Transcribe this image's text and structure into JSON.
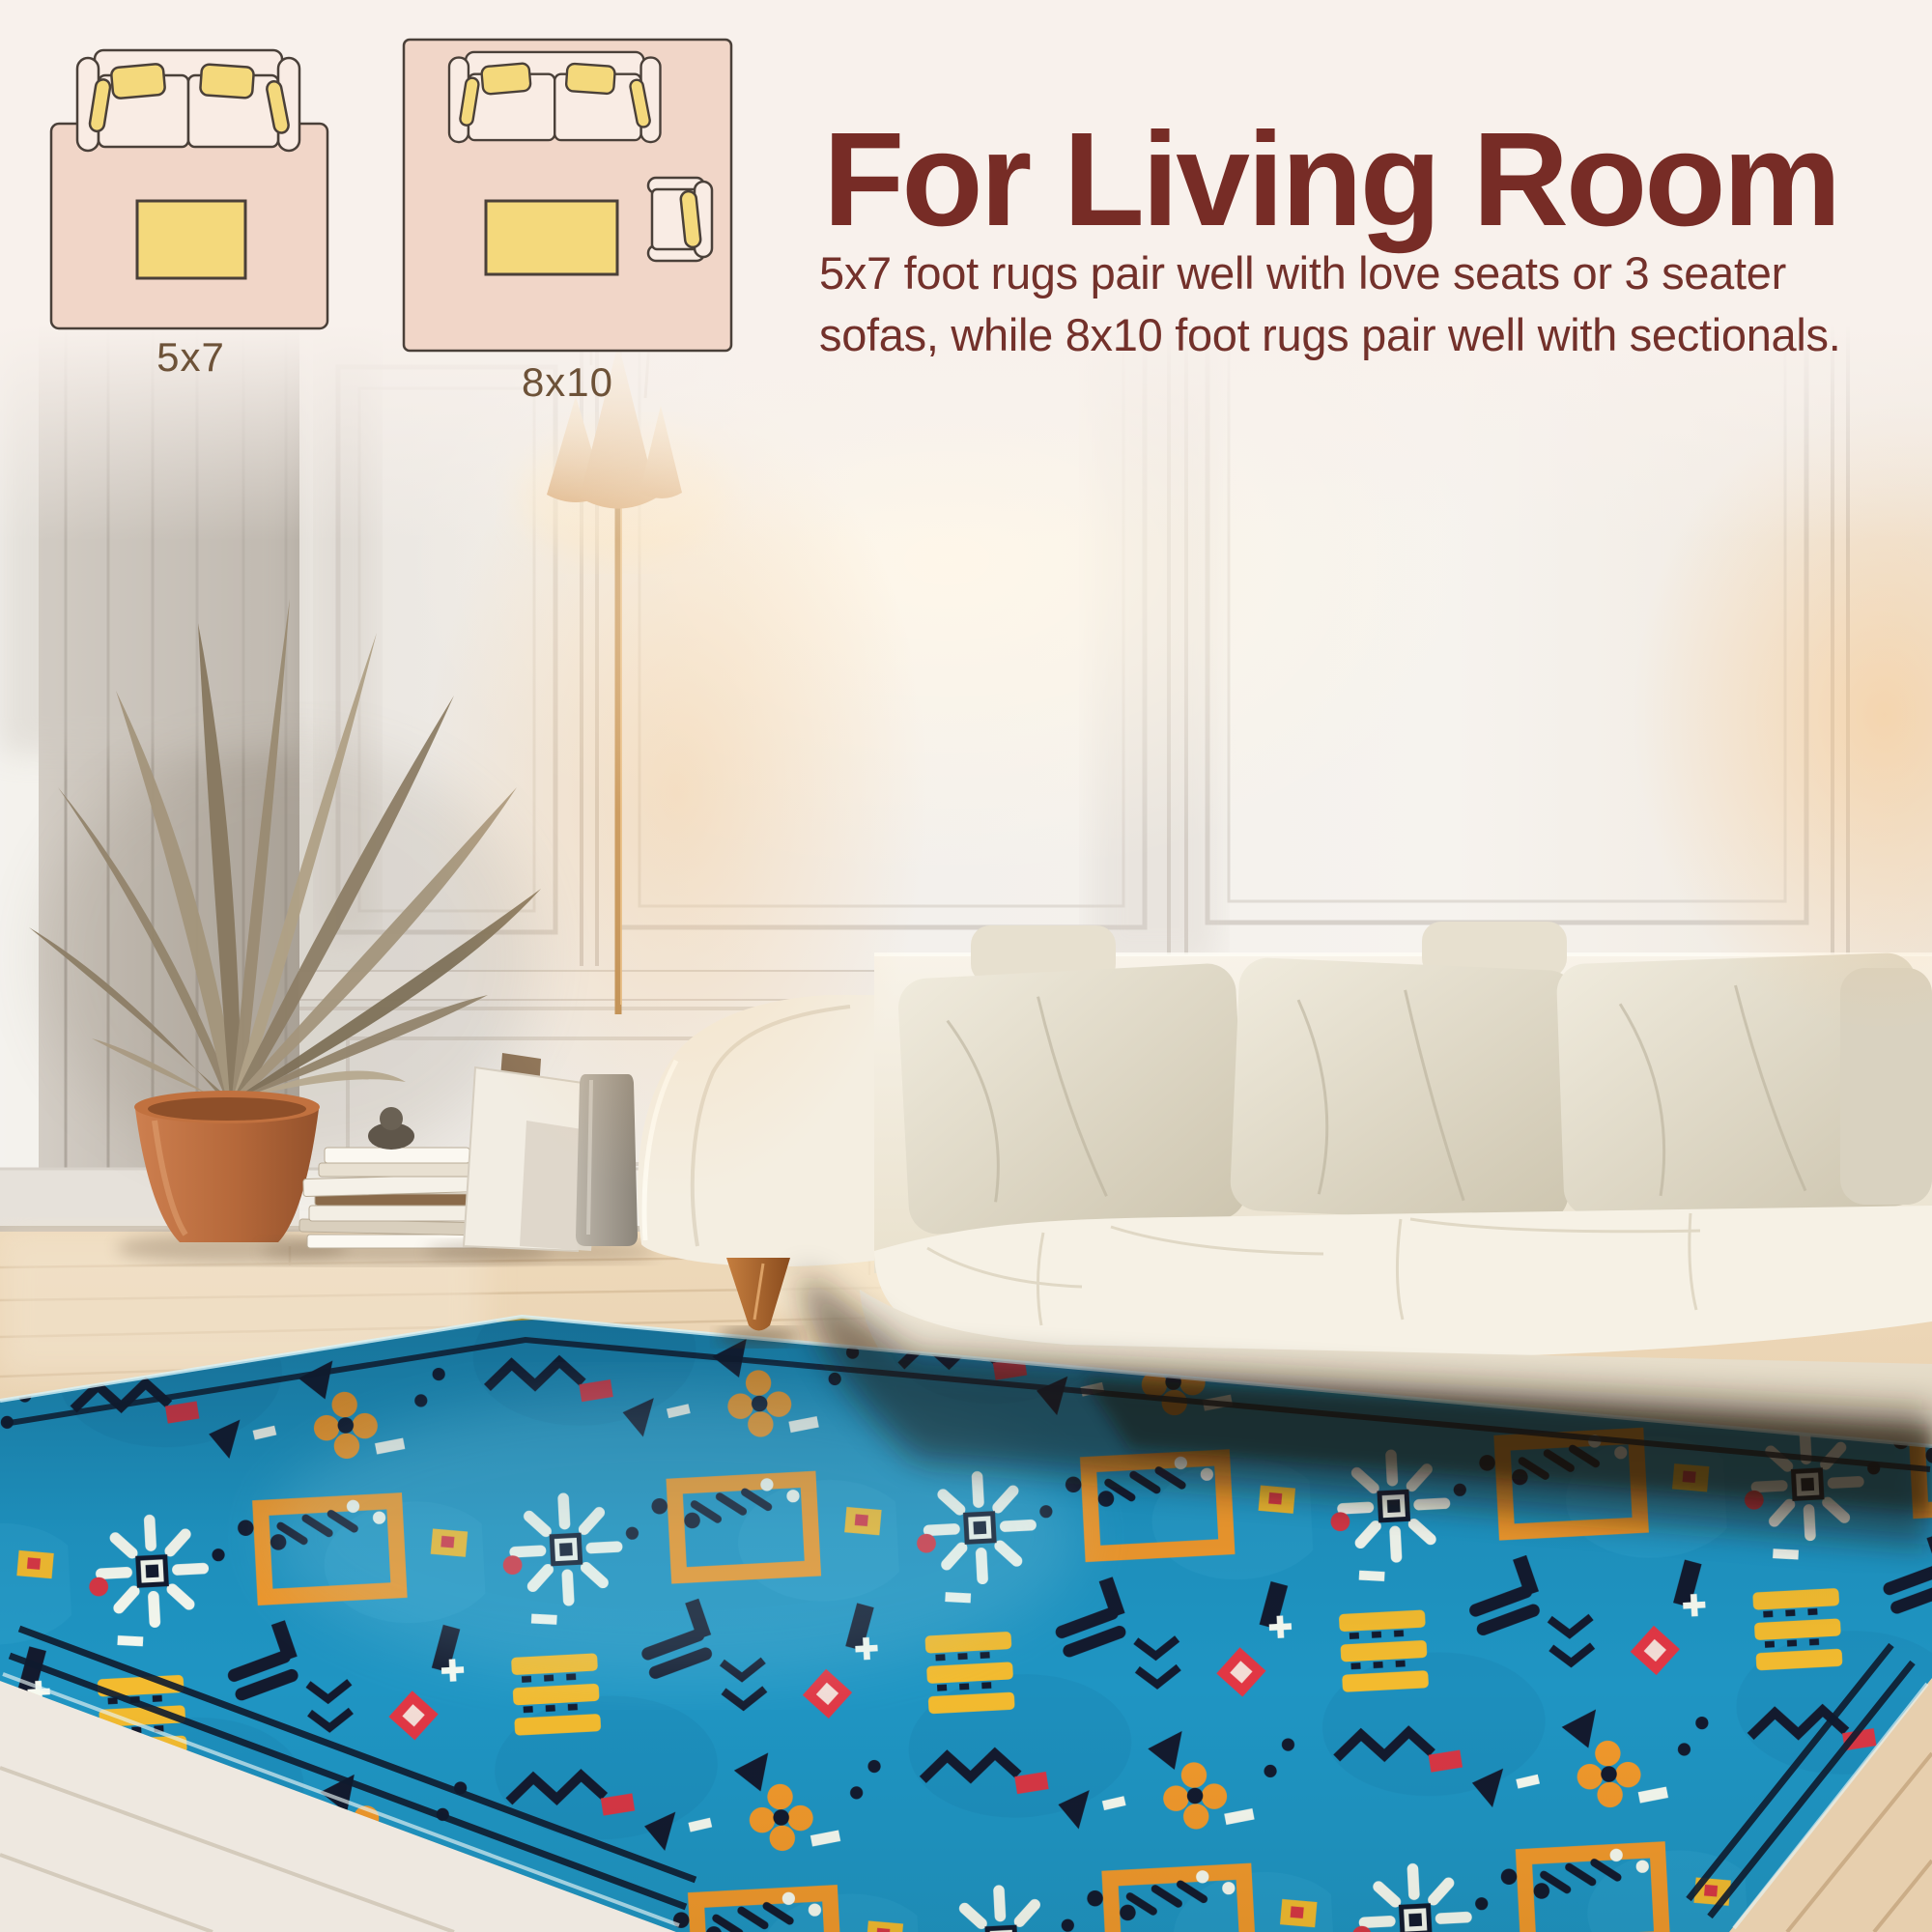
{
  "page": {
    "kind": "rug-product-infographic",
    "background": "#f8f1ec"
  },
  "header": {
    "title": "For Living Room",
    "description": "5x7 foot rugs pair well with love seats or 3 seater\nsofas, while 8x10 foot rugs pair well with sectionals."
  },
  "size_diagrams": [
    {
      "label": "5x7",
      "furniture": [
        "sofa-top-view",
        "coffee-table"
      ]
    },
    {
      "label": "8x10",
      "furniture": [
        "sofa-top-view",
        "coffee-table",
        "armchair-top-view"
      ]
    }
  ],
  "scene": {
    "objects": [
      "paneled-wall",
      "floor-lamp",
      "palm-plant",
      "terracotta-pot",
      "book-stack",
      "leaning-canvases",
      "decor-vase",
      "cream-sofa",
      "throw-pillows",
      "wood-floor",
      "blue-tribal-rug"
    ]
  },
  "colors": {
    "header_bg": "#f8f1ec",
    "title_text": "#772c26",
    "body_text": "#73312b",
    "label_text": "#6d5238",
    "diagram_rug": "#f1d6c8",
    "diagram_outline": "#4a4039",
    "furniture_fill": "#f9ece4",
    "pillow_yellow": "#f4d97c",
    "rug_blue": "#1f95c3",
    "rug_navy": "#131a2e",
    "rug_orange": "#f2992b",
    "rug_yellow": "#f3bb2f",
    "rug_red": "#e23744",
    "rug_white": "#f7faf0",
    "sofa_cream": "#f5f0e4",
    "pot_terracotta": "#bb6f42",
    "wall_light": "#efeae4",
    "floor_wood": "#e2c9a6"
  }
}
